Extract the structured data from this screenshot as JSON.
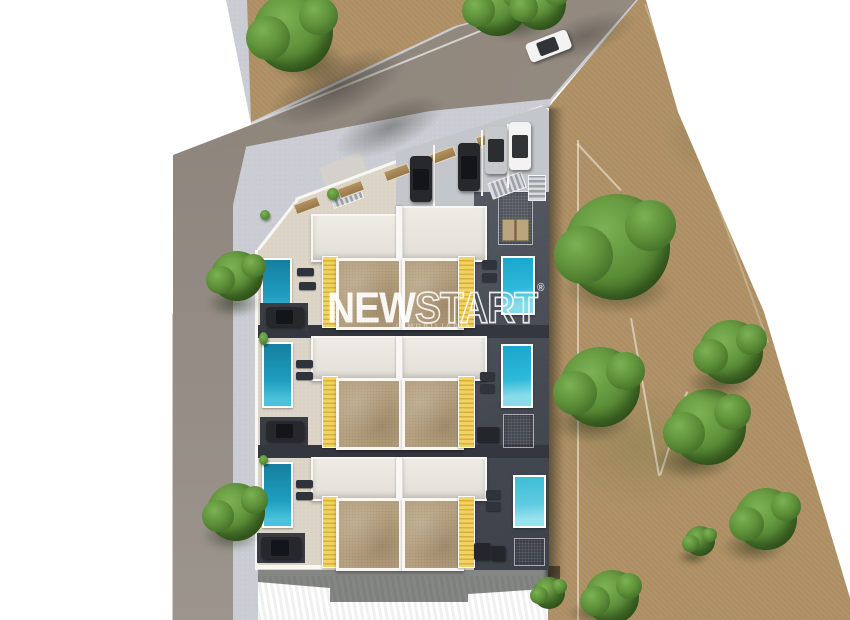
{
  "watermark": {
    "brand_solid": "NEW",
    "brand_outline": "START",
    "registered": "®",
    "subtitle": "INMOBILIARIA"
  },
  "palette": {
    "page_bg": "#ffffff",
    "sidewalk": "#c9ccd2",
    "road": "#8b837a",
    "dirt": "#b29368",
    "terrace": "#dbd4c6",
    "paving_light": "#c3c6ca",
    "charcoal": "#4b4f58",
    "charcoal_dark": "#343740",
    "wall": "#f8f7f4",
    "roof": "#e9e6df",
    "solarium": "#b7a281",
    "awning": "#f2d35f",
    "awning_dark": "#d8ae3c",
    "pool_a": "#1ba6cb",
    "pool_b": "#2cb9da",
    "pool_c": "#8adbe9",
    "lawn": "#41a02c",
    "grass_a": "#667040",
    "tree_light": "#7cb254",
    "tree_main": "#5d8f38",
    "tree_dark": "#3f6b26",
    "car_dark": "#26282c",
    "car_white": "#f2f3f2",
    "car_silver": "#c6c8c9"
  }
}
